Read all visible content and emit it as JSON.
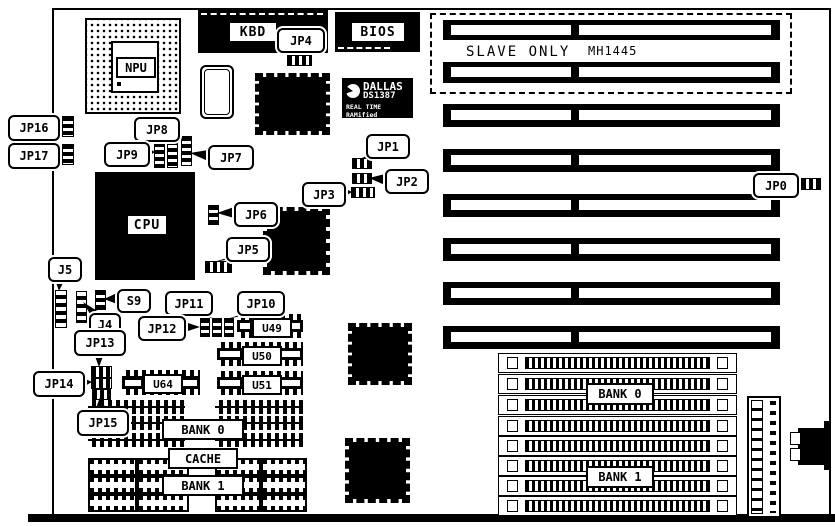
{
  "colors": {
    "ink": "#000000",
    "paper": "#ffffff"
  },
  "chips": {
    "npu": "NPU",
    "cpu": "CPU",
    "kbd": "KBD",
    "bios": "BIOS"
  },
  "rtc": {
    "brand": "DALLAS",
    "part": "DS1387",
    "tagline": "REAL TIME RAMified"
  },
  "expansion": {
    "slave_only": "SLAVE ONLY",
    "part_number": "MH1445"
  },
  "callouts": {
    "jp0": "JP0",
    "jp1": "JP1",
    "jp2": "JP2",
    "jp3": "JP3",
    "jp4": "JP4",
    "jp5": "JP5",
    "jp6": "JP6",
    "jp7": "JP7",
    "jp8": "JP8",
    "jp9": "JP9",
    "jp10": "JP10",
    "jp11": "JP11",
    "jp12": "JP12",
    "jp13": "JP13",
    "jp14": "JP14",
    "jp15": "JP15",
    "jp16": "JP16",
    "jp17": "JP17",
    "j4": "J4",
    "j5": "J5",
    "s9": "S9"
  },
  "ics": {
    "u49": "U49",
    "u50": "U50",
    "u51": "U51",
    "u64": "U64"
  },
  "cache": {
    "bank0": "BANK 0",
    "label": "CACHE",
    "bank1": "BANK 1"
  },
  "simm": {
    "bank0": "BANK 0",
    "bank1": "BANK 1"
  }
}
